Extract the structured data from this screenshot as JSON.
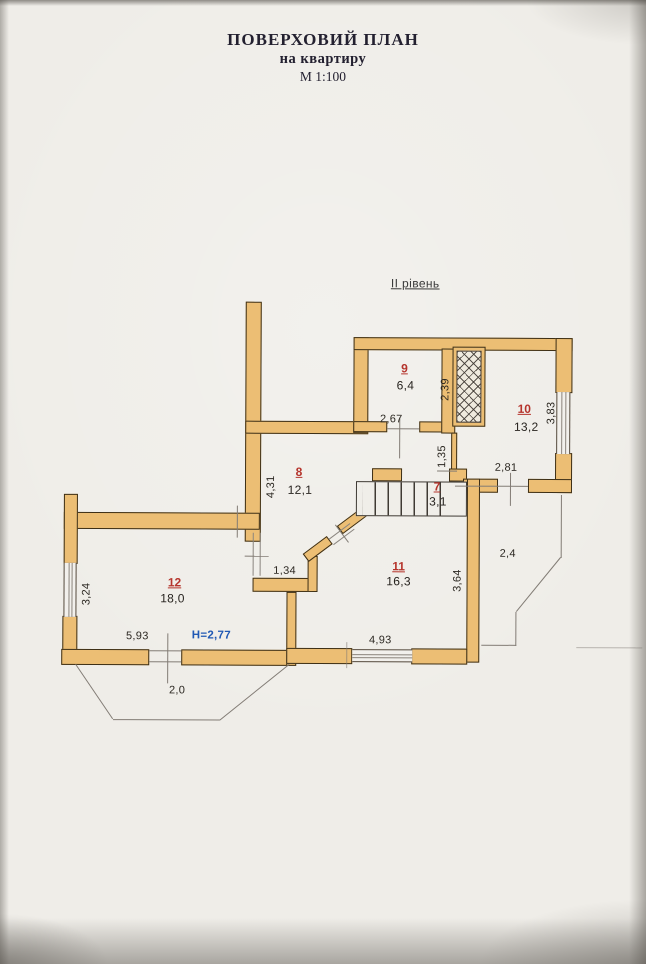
{
  "document": {
    "title": "ПОВЕРХОВИЙ ПЛАН",
    "subtitle": "на квартиру",
    "scale": "М 1:100",
    "level": "ІІ рівень",
    "height_mark": "Н=2,77"
  },
  "rooms": {
    "r7": {
      "number": "7",
      "area": "3,1"
    },
    "r8": {
      "number": "8",
      "area": "12,1"
    },
    "r9": {
      "number": "9",
      "area": "6,4"
    },
    "r10": {
      "number": "10",
      "area": "13,2"
    },
    "r11": {
      "number": "11",
      "area": "16,3"
    },
    "r12": {
      "number": "12",
      "area": "18,0"
    }
  },
  "dimensions": {
    "room9_width": "2,67",
    "room9_depth": "2,39",
    "room10_window": "3,83",
    "corridor": "1,35",
    "room10_width": "2,81",
    "room8_depth": "4,31",
    "terrace_right": "2,4",
    "room11_depth": "3,64",
    "nook_width": "1,34",
    "room12_window": "3,24",
    "room12_width": "5,93",
    "room11_width": "4,93",
    "balcony_depth": "2,0"
  },
  "colors": {
    "wall_fill": "#ecbe74",
    "wall_outline": "#3d2f16",
    "room_number_red": "#b5342c",
    "height_mark_blue": "#1f58b4",
    "paper": "#efede8"
  }
}
